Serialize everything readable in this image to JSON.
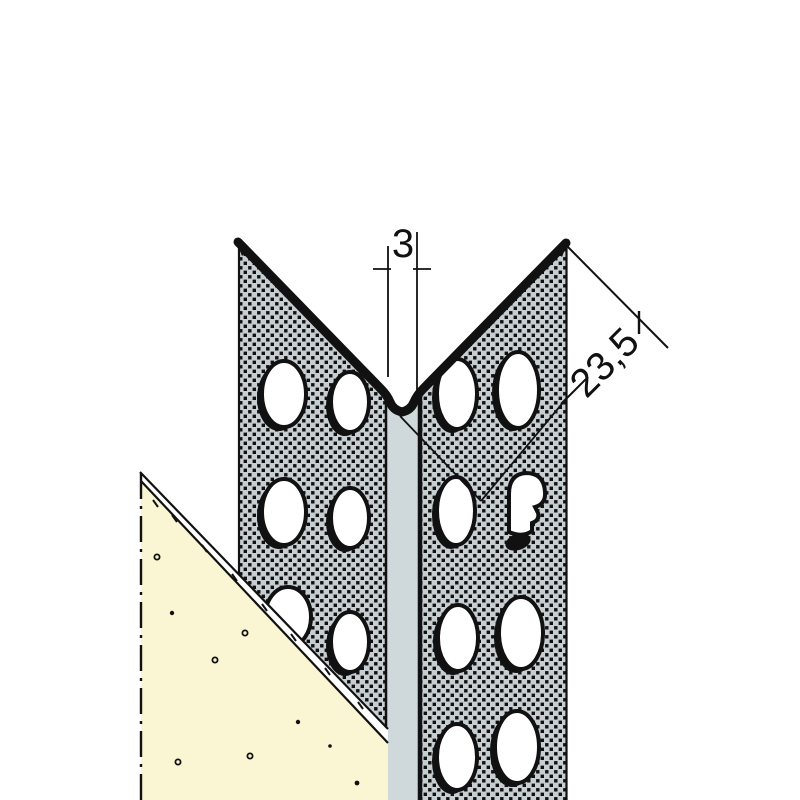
{
  "drawing": {
    "title": "perforated corner bead profile with plaster coat - sectional catalog drawing",
    "dim_slot": {
      "label": "3"
    },
    "dim_flange": {
      "label": "23,5"
    }
  },
  "colors": {
    "background": "#ffffff",
    "flange_fill": "#c7ced1",
    "stipple_dot": "#101010",
    "strip_fill": "#cfd8da",
    "plaster_fill": "#faf6d3",
    "line": "#111111"
  }
}
